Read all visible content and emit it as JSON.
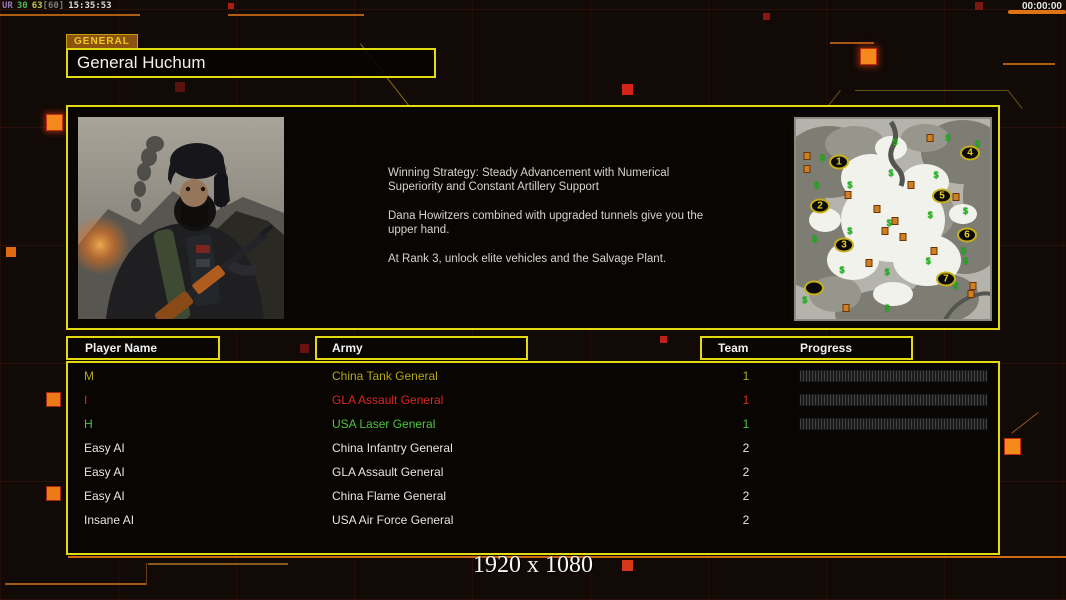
{
  "hud": {
    "fps_overlay": [
      {
        "text": "UR",
        "color": "#9a78b8"
      },
      {
        "text": "30",
        "color": "#55b855"
      },
      {
        "text": "63",
        "color": "#c8c452"
      },
      {
        "text": "[60]",
        "color": "#7c7c7c"
      },
      {
        "text": "15:35:53",
        "color": "#dddddd"
      }
    ],
    "match_timer": "00:00:00"
  },
  "header": {
    "tab_label": "GENERAL",
    "title": "General Huchum"
  },
  "bio": {
    "paragraphs": [
      "Winning Strategy: Steady Advancement with Numerical Superiority and Constant Artillery Support",
      "Dana Howitzers combined with upgraded tunnels give you the upper hand.",
      "At Rank 3, unlock elite vehicles and the Salvage Plant."
    ]
  },
  "minimap": {
    "start_positions": [
      {
        "label": "1",
        "x": 22.4,
        "y": 21.8
      },
      {
        "label": "2",
        "x": 12.8,
        "y": 43.6
      },
      {
        "label": "3",
        "x": 25.0,
        "y": 62.9
      },
      {
        "label": "4",
        "x": 89.3,
        "y": 17.3
      },
      {
        "label": "5",
        "x": 75.0,
        "y": 38.6
      },
      {
        "label": "6",
        "x": 87.8,
        "y": 57.9
      },
      {
        "label": "7",
        "x": 77.0,
        "y": 79.7
      }
    ],
    "empty_position": {
      "label": "",
      "x": 9.7,
      "y": 84.2
    },
    "supply_symbol": "$",
    "supply_markers": [
      {
        "x": 51,
        "y": 12
      },
      {
        "x": 78,
        "y": 10
      },
      {
        "x": 93,
        "y": 13
      },
      {
        "x": 14,
        "y": 20
      },
      {
        "x": 49,
        "y": 27
      },
      {
        "x": 72,
        "y": 28
      },
      {
        "x": 28,
        "y": 33
      },
      {
        "x": 11,
        "y": 33
      },
      {
        "x": 87,
        "y": 46
      },
      {
        "x": 48,
        "y": 52
      },
      {
        "x": 69,
        "y": 48
      },
      {
        "x": 10,
        "y": 60
      },
      {
        "x": 28,
        "y": 56
      },
      {
        "x": 87,
        "y": 71
      },
      {
        "x": 68,
        "y": 71
      },
      {
        "x": 24,
        "y": 75
      },
      {
        "x": 47,
        "y": 76
      },
      {
        "x": 82,
        "y": 83
      },
      {
        "x": 5,
        "y": 90
      },
      {
        "x": 47,
        "y": 94
      },
      {
        "x": 86,
        "y": 66
      }
    ],
    "structure_markers": [
      {
        "x": 69,
        "y": 10
      },
      {
        "x": 6,
        "y": 19
      },
      {
        "x": 6,
        "y": 25
      },
      {
        "x": 27,
        "y": 38
      },
      {
        "x": 59,
        "y": 33
      },
      {
        "x": 42,
        "y": 45
      },
      {
        "x": 51,
        "y": 51
      },
      {
        "x": 46,
        "y": 56
      },
      {
        "x": 55,
        "y": 59
      },
      {
        "x": 82,
        "y": 39
      },
      {
        "x": 71,
        "y": 66
      },
      {
        "x": 38,
        "y": 72
      },
      {
        "x": 91,
        "y": 83
      },
      {
        "x": 90,
        "y": 87
      },
      {
        "x": 26,
        "y": 94
      }
    ]
  },
  "roster": {
    "headers": {
      "player": "Player Name",
      "army": "Army",
      "team": "Team",
      "progress": "Progress"
    },
    "rows": [
      {
        "player": "M",
        "army": "China Tank General",
        "team": "1",
        "color": "#b4a814",
        "has_progress": true
      },
      {
        "player": "I",
        "army": "GLA Assault General",
        "team": "1",
        "color": "#da2a20",
        "has_progress": true
      },
      {
        "player": "H",
        "army": "USA Laser General",
        "team": "1",
        "color": "#4cc83a",
        "has_progress": true
      },
      {
        "player": "Easy AI",
        "army": "China Infantry General",
        "team": "2",
        "color": "#e6e6e6",
        "has_progress": false
      },
      {
        "player": "Easy AI",
        "army": "GLA Assault General",
        "team": "2",
        "color": "#e6e6e6",
        "has_progress": false
      },
      {
        "player": "Easy AI",
        "army": "China Flame General",
        "team": "2",
        "color": "#e6e6e6",
        "has_progress": false
      },
      {
        "player": "Insane AI",
        "army": "USA Air Force General",
        "team": "2",
        "color": "#e6e6e6",
        "has_progress": false
      }
    ]
  },
  "footer": {
    "resolution": "1920 x 1080"
  },
  "colors": {
    "accent_yellow": "#e3da12",
    "accent_orange": "#e87818",
    "tab_background": "#8a5410",
    "team1_yellow": "#b4a814",
    "team1_red": "#da2a20",
    "team1_green": "#4cc83a"
  }
}
